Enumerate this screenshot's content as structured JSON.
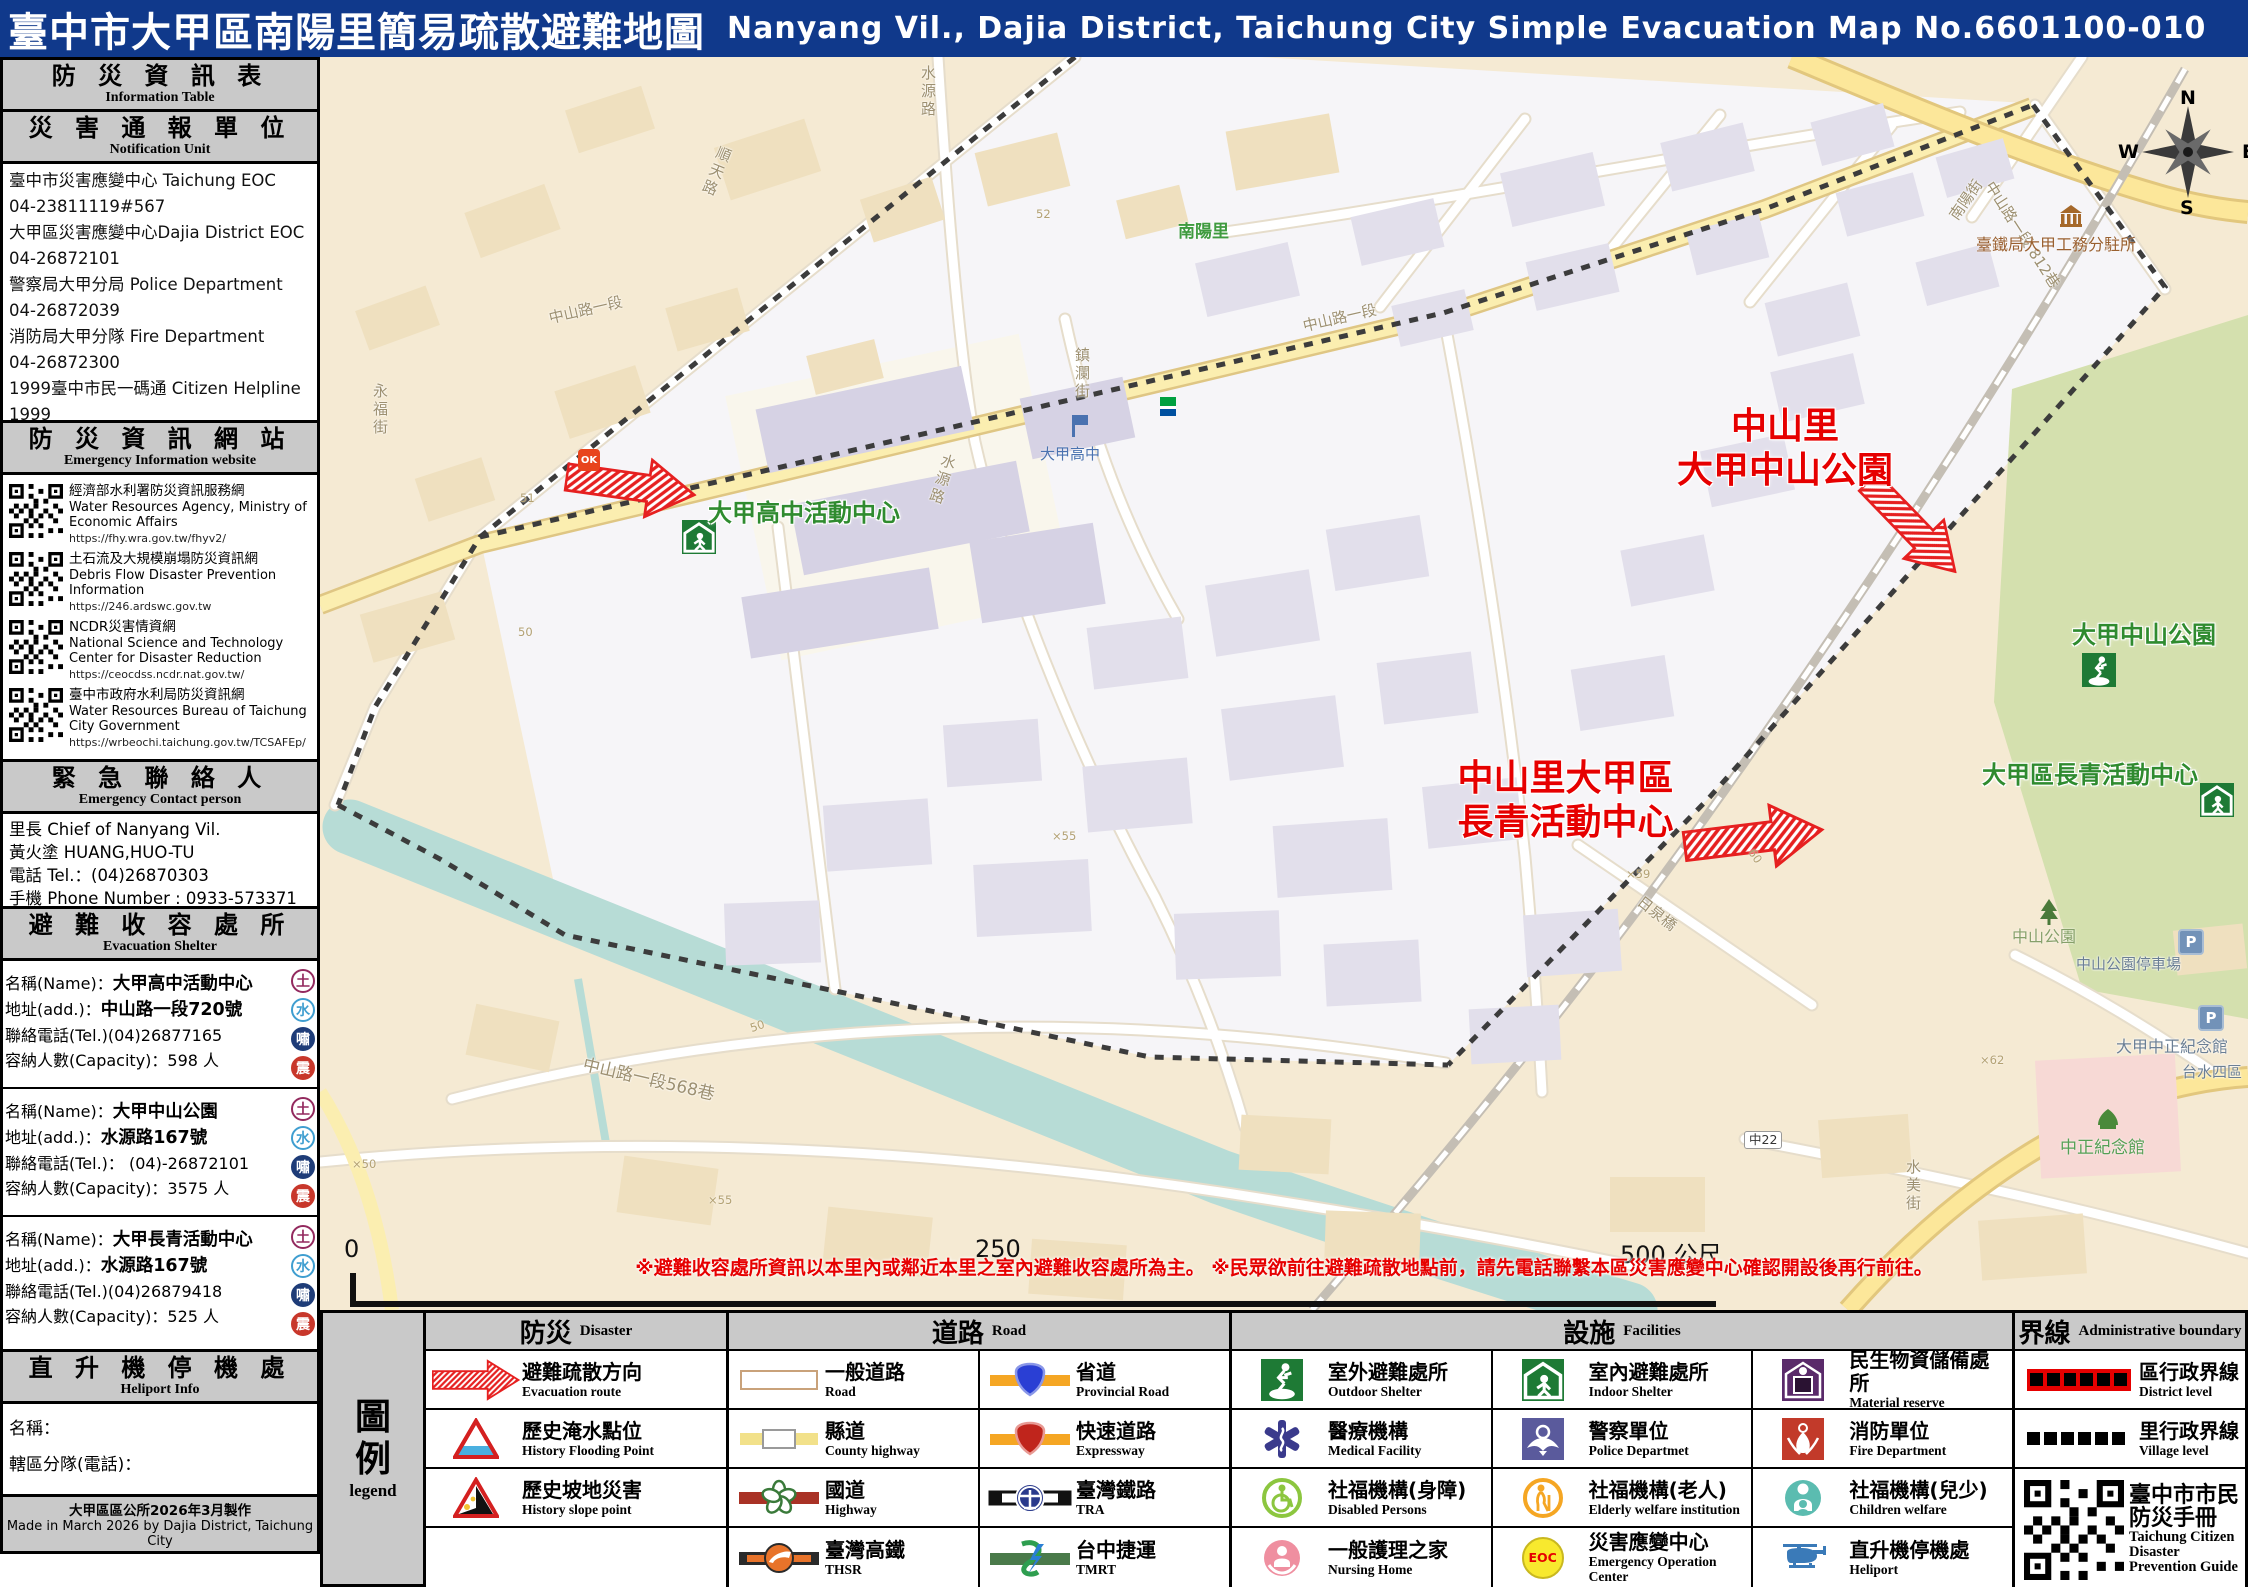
{
  "title": {
    "zh": "臺中市大甲區南陽里簡易疏散避難地圖",
    "en": "Nanyang Vil., Dajia District, Taichung City Simple Evacuation Map No.6601100-010"
  },
  "sidebar": {
    "info_header": {
      "zh": "防 災 資 訊 表",
      "en": "Information Table"
    },
    "notify_header": {
      "zh": "災 害 通 報 單 位",
      "en": "Notification Unit"
    },
    "notify": [
      {
        "name": "臺中市災害應變中心 Taichung EOC",
        "phone": "04-23811119#567"
      },
      {
        "name": "大甲區災害應變中心Dajia District EOC",
        "phone": "04-26872101"
      },
      {
        "name": "警察局大甲分局 Police Department",
        "phone": "04-26872039"
      },
      {
        "name": "消防局大甲分隊 Fire Department",
        "phone": "04-26872300"
      },
      {
        "name": "1999臺中市民一碼通 Citizen Helpline",
        "phone": "1999"
      }
    ],
    "web_header": {
      "zh": "防 災 資 訊 網 站",
      "en": "Emergency Information website"
    },
    "websites": [
      {
        "zh": "經濟部水利署防災資訊服務網",
        "en": "Water Resources Agency, Ministry of Economic Affairs",
        "url": "https://fhy.wra.gov.tw/fhyv2/"
      },
      {
        "zh": "土石流及大規模崩塌防災資訊網",
        "en": "Debris Flow Disaster Prevention Information",
        "url": "https://246.ardswc.gov.tw"
      },
      {
        "zh": "NCDR災害情資網",
        "en": "National Science and Technology Center for Disaster Reduction",
        "url": "https://ceocdss.ncdr.nat.gov.tw/"
      },
      {
        "zh": "臺中市政府水利局防災資訊網",
        "en": "Water Resources Bureau of Taichung City Government",
        "url": "https://wrbeochi.taichung.gov.tw/TCSAFEp/"
      }
    ],
    "contact_header": {
      "zh": "緊 急 聯 絡 人",
      "en": "Emergency Contact person"
    },
    "contact": [
      "里長 Chief of Nanyang Vil.",
      "黃火塗 HUANG,HUO-TU",
      "電話 Tel.：(04)26870303",
      "手機 Phone Number : 0933-573371"
    ],
    "shelter_header": {
      "zh": "避 難 收 容 處 所",
      "en": "Evacuation Shelter"
    },
    "shelters": [
      {
        "name_label": "名稱(Name)：",
        "name": "大甲高中活動中心",
        "addr_label": "地址(add.)：",
        "addr": "中山路一段720號",
        "tel": "聯絡電話(Tel.)(04)26877165",
        "cap": "容納人數(Capacity)：598 人"
      },
      {
        "name_label": "名稱(Name)：",
        "name": "大甲中山公園",
        "addr_label": "地址(add.)：",
        "addr": "水源路167號",
        "tel": "聯絡電話(Tel.)： (04)-26872101",
        "cap": "容納人數(Capacity)：3575 人"
      },
      {
        "name_label": "名稱(Name)：",
        "name": "大甲長青活動中心",
        "addr_label": "地址(add.)：",
        "addr": "水源路167號",
        "tel": "聯絡電話(Tel.)(04)26879418",
        "cap": "容納人數(Capacity)：525 人"
      }
    ],
    "badges": [
      "土",
      "水",
      "嘯",
      "震"
    ],
    "heliport_header": {
      "zh": "直 升 機 停 機 處",
      "en": "Heliport Info"
    },
    "heliport": [
      "名稱：",
      "轄區分隊(電話)："
    ],
    "footer": {
      "zh": "大甲區區公所2026年3月製作",
      "en": "Made in March 2026 by Dajia District, Taichung City"
    }
  },
  "map": {
    "labels": {
      "shuntian_rd": "順天路",
      "shuiyuan_rd_top": "水源路",
      "shuiyuan_rd_mid": "水源路",
      "yongfu_st": "永福街",
      "zhongshan_rd_1": "中山路一段",
      "zhongshan_rd_2": "中山路一段",
      "zhongshan_568": "中山路一段568巷",
      "zhongshan_812": "中山路一段 812巷",
      "nanyang_st": "南陽街",
      "zhenlan_st": "鎮瀾街",
      "shuimei_st": "水美街",
      "nanyang_vil": "南陽里",
      "dajia_hs": "大甲高中",
      "dajia_hs_center": "大甲高中活動中心",
      "evac1_line1": "中山里",
      "evac1_line2": "大甲中山公園",
      "evac2_line1": "中山里大甲區",
      "evac2_line2": "長青活動中心",
      "zhongshan_park_green": "大甲中山公園",
      "evergreen_green": "大甲區長青活動中心",
      "tra_office": "臺鐵局大甲工務分駐所",
      "zhongshan_park": "中山公園",
      "zhongshan_parking": "中山公園停車場",
      "cks_memorial_poi": "大甲中正紀念館",
      "taiwater": "台水四區",
      "cks_memorial": "中正紀念館",
      "riquan_bridge": "日泉橋",
      "rd_no": "中22",
      "ok_mart": "OK",
      "parking_p": "P",
      "parking_p2": "P",
      "elev_51": "51",
      "elev_50": "50",
      "elev_50b": "50",
      "elev_52": "52",
      "x50": "×50",
      "x55": "×55",
      "x55b": "×55",
      "x59": "×59",
      "elev_60": "60",
      "x62": "×62"
    },
    "compass": {
      "n": "N",
      "e": "E",
      "s": "S",
      "w": "W"
    },
    "scale": {
      "t0": "0",
      "t250": "250",
      "t500": "500 公尺"
    },
    "note": "※避難收容處所資訊以本里內或鄰近本里之室內避難收容處所為主。 ※民眾欲前往避難疏散地點前，請先電話聯繫本區災害應變中心確認開設後再行前往。"
  },
  "legend": {
    "side": {
      "zh": "圖例",
      "en": "legend"
    },
    "headers": {
      "disaster": {
        "zh": "防災",
        "en": "Disaster"
      },
      "road": {
        "zh": "道路",
        "en": "Road"
      },
      "facility": {
        "zh": "設施",
        "en": "Facilities"
      },
      "boundary": {
        "zh": "界線",
        "en": "Administrative boundary"
      }
    },
    "disaster": [
      {
        "zh": "避難疏散方向",
        "en": "Evacuation route"
      },
      {
        "zh": "歷史淹水點位",
        "en": "History Flooding Point"
      },
      {
        "zh": "歷史坡地災害",
        "en": "History slope point"
      }
    ],
    "road": [
      {
        "zh": "一般道路",
        "en": "Road"
      },
      {
        "zh": "縣道",
        "en": "County highway"
      },
      {
        "zh": "國道",
        "en": "Highway"
      },
      {
        "zh": "臺灣高鐵",
        "en": "THSR"
      },
      {
        "zh": "省道",
        "en": "Provincial Road"
      },
      {
        "zh": "快速道路",
        "en": "Expressway"
      },
      {
        "zh": "臺灣鐵路",
        "en": "TRA"
      },
      {
        "zh": "台中捷運",
        "en": "TMRT"
      }
    ],
    "facility": [
      {
        "zh": "室外避難處所",
        "en": "Outdoor Shelter"
      },
      {
        "zh": "醫療機構",
        "en": "Medical Facility"
      },
      {
        "zh": "社福機構(身障)",
        "en": "Disabled Persons"
      },
      {
        "zh": "一般護理之家",
        "en": "Nursing Home"
      },
      {
        "zh": "室內避難處所",
        "en": "Indoor Shelter"
      },
      {
        "zh": "警察單位",
        "en": "Police Departmet"
      },
      {
        "zh": "社福機構(老人)",
        "en": "Elderly welfare institution"
      },
      {
        "zh": "災害應變中心",
        "en": "Emergency Operation Center"
      },
      {
        "zh": "民生物資儲備處所",
        "en": "Material reserve"
      },
      {
        "zh": "消防單位",
        "en": "Fire Department"
      },
      {
        "zh": "社福機構(兒少)",
        "en": "Children welfare"
      },
      {
        "zh": "直升機停機處",
        "en": "Heliport"
      }
    ],
    "eoc_text": "EOC",
    "boundary": [
      {
        "zh": "區行政界線",
        "en": "District level"
      },
      {
        "zh": "里行政界線",
        "en": "Village level"
      }
    ],
    "guide": {
      "zh": "臺中市市民防災手冊",
      "en": "Taichung Citizen Disaster Prevention Guide"
    }
  }
}
